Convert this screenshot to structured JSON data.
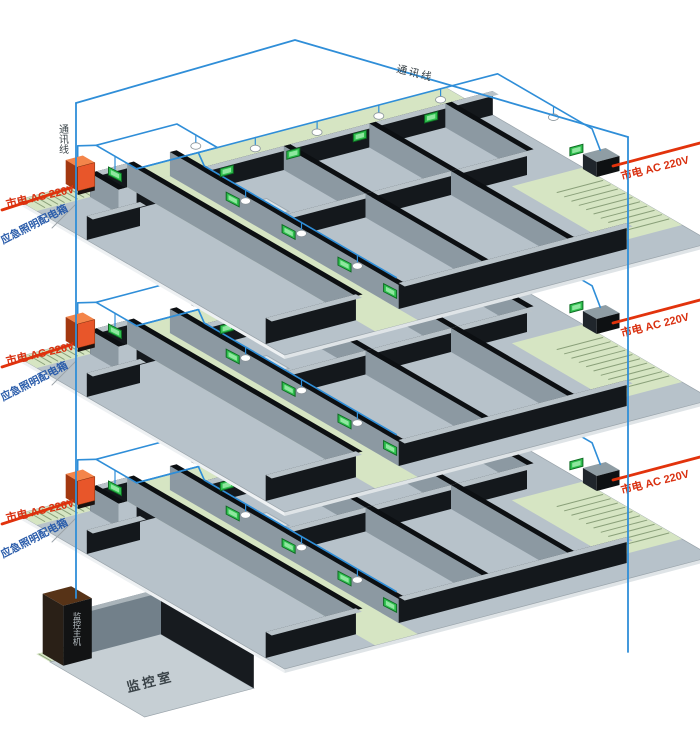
{
  "diagram": {
    "type": "isometric-emergency-lighting-wiring-diagram",
    "comm_line_top_label": "通讯线",
    "comm_line_left_label": "通讯线",
    "floors": [
      {
        "name": "floor-1",
        "mains_left": "市电 AC 220V",
        "distribution_box": "应急照明配电箱",
        "mains_right": "市电 AC 220V"
      },
      {
        "name": "floor-2",
        "mains_left": "市电 AC 220V",
        "distribution_box": "应急照明配电箱",
        "mains_right": "市电 AC 220V"
      },
      {
        "name": "floor-3",
        "mains_left": "市电 AC 220V",
        "distribution_box": "应急照明配电箱",
        "mains_right": "市电 AC 220V"
      }
    ],
    "monitor_room": {
      "room_label": "监控室",
      "host_label": "监控主机"
    },
    "colors": {
      "background": "#ffffff",
      "comm_line": "#2f8ed8",
      "mains_line": "#e2330c",
      "mains_text": "#d93010",
      "dist_box_text": "#2a5caa",
      "dist_box_front": "#e8562a",
      "dist_box_side": "#a33810",
      "dist_box_top": "#f4854a",
      "dist_box_base": "#1a1210",
      "floor_plate": "#b7c2ca",
      "floor_plate_edge": "#9aa4ab",
      "slab_edge_se": "#dfe4e7",
      "slab_edge_sw": "#eef1f3",
      "corridor_green": "#d6e5c3",
      "stairs_line": "#8aa07a",
      "wall_dark_side": "#14181c",
      "wall_light_top": "#b9c3c9",
      "wall_light_side": "#8c99a2",
      "wall_dark_top": "#0c0f12",
      "opening_fill": "#dde4e8",
      "opening_edge": "#9fa9b0",
      "lamp_fill": "#ffffff",
      "lamp_stroke": "#8a949a",
      "exit_sign": "#2fbf4e",
      "exit_sign_border": "#0d6b22",
      "exit_sign_inner": "#8fe79f",
      "right_box_top": "#8f9da4",
      "right_box_front": "#0e1113",
      "right_box_side": "#20262c",
      "label_dark": "#3a4348",
      "leader_line": "#9aa2a8",
      "room_floor": "#c6cfd4",
      "room_wall_light": "#72808a",
      "room_wall_dark": "#171b1f",
      "room_wall_top": "#aab4ba",
      "cabinet_front": "#121314",
      "cabinet_top": "#573317",
      "cabinet_side": "#2a2017",
      "cabinet_text": "#b7bfc4"
    }
  }
}
